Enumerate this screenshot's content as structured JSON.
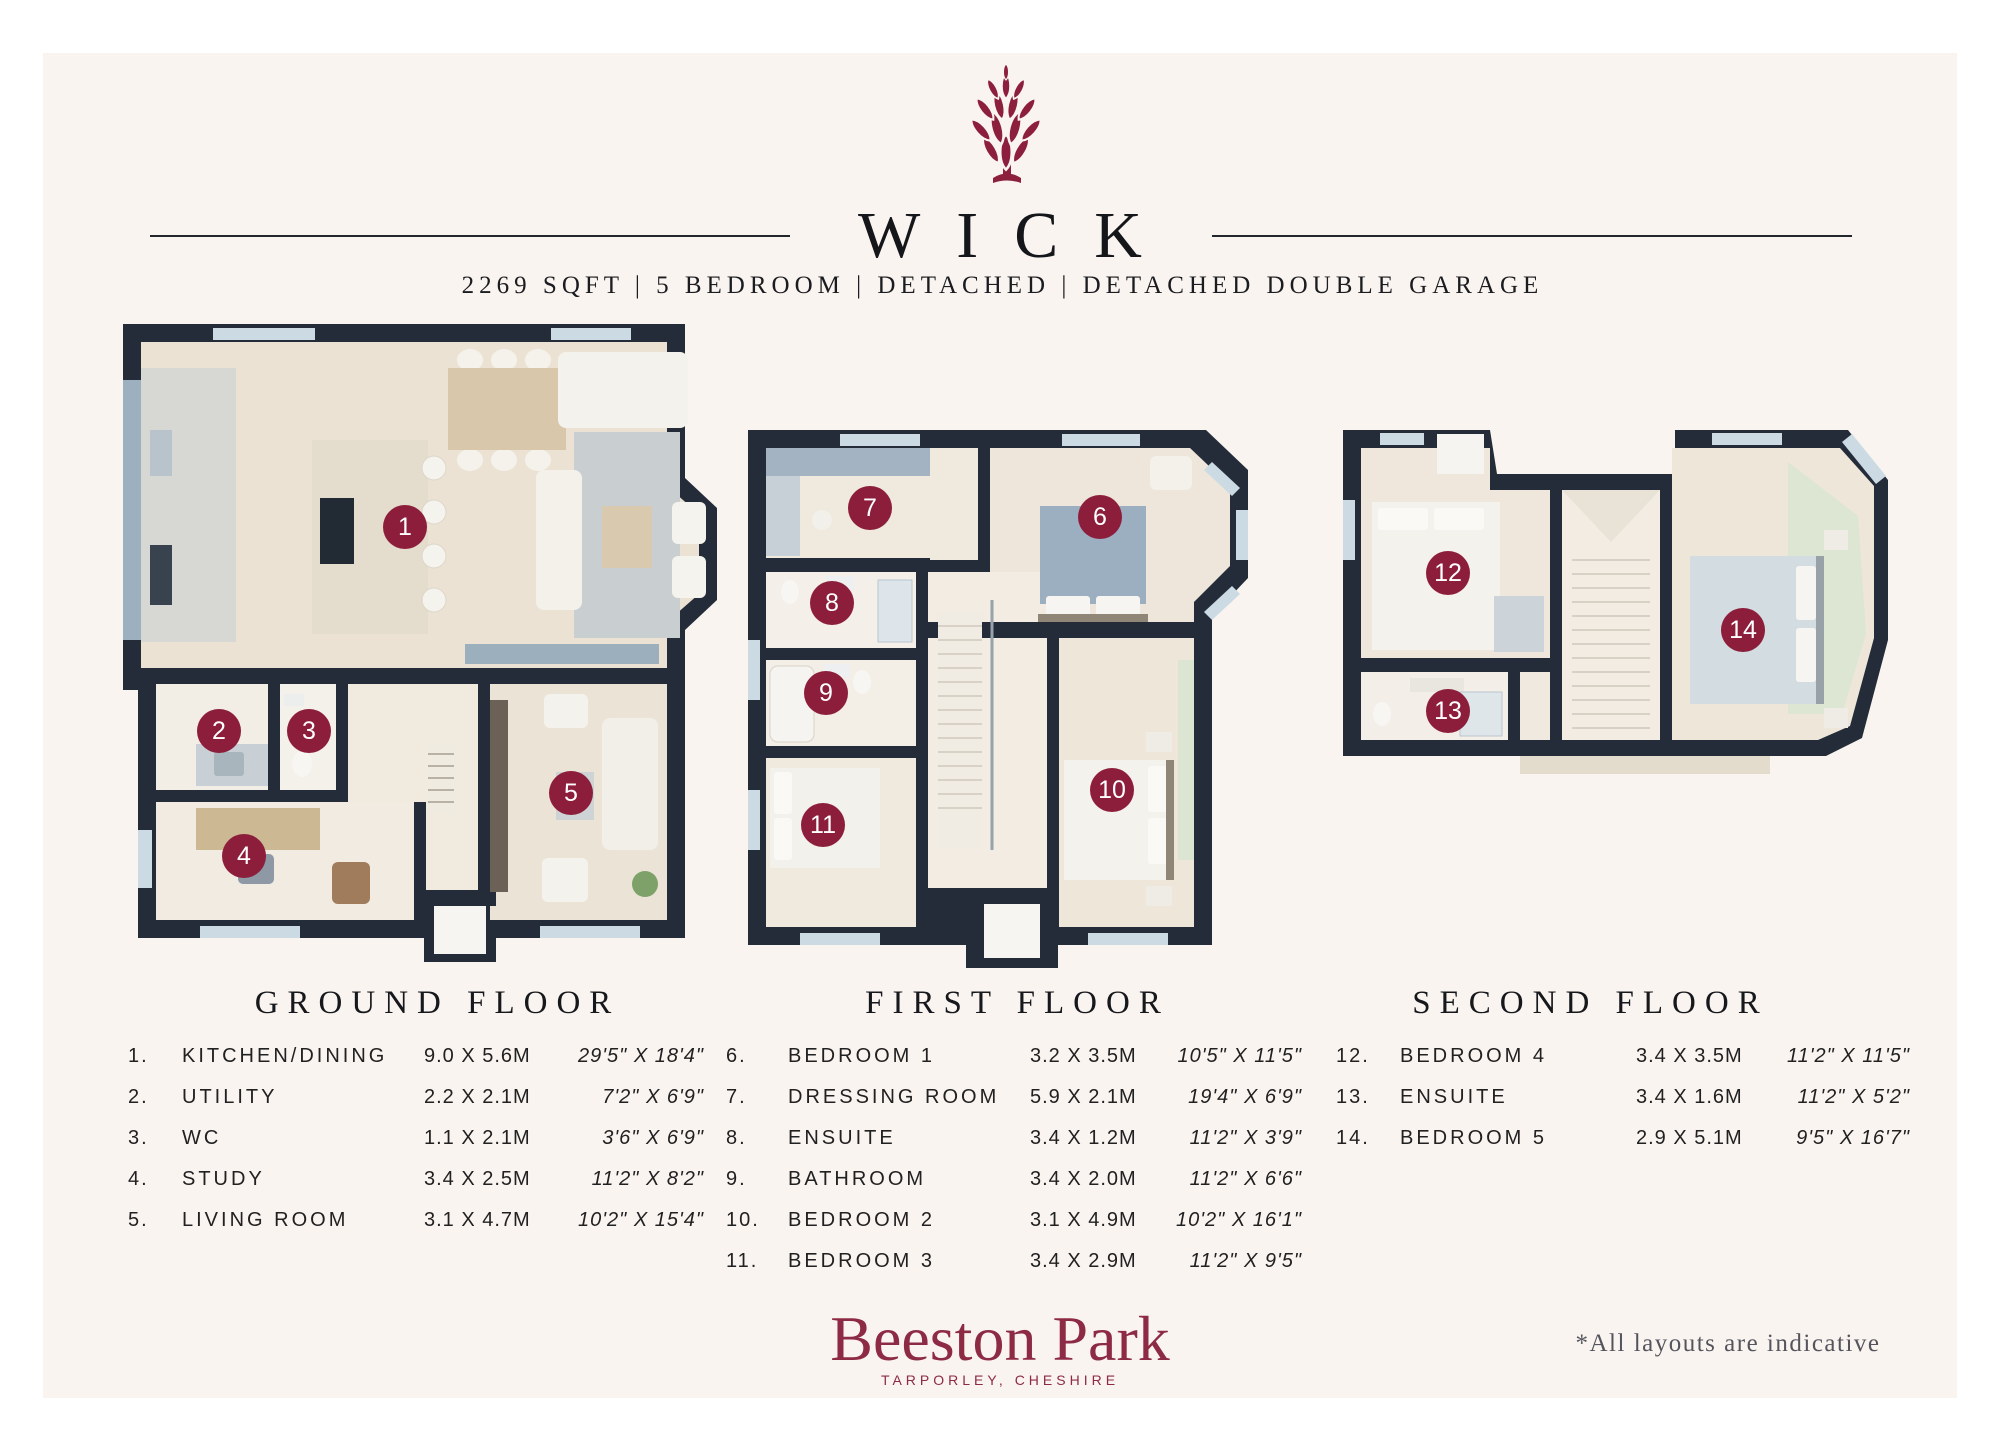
{
  "header": {
    "logo": "artichoke-logo",
    "title": "WICK",
    "subtitle": "2269 SQFT | 5 BEDROOM | DETACHED | DETACHED DOUBLE GARAGE"
  },
  "floors": [
    {
      "label": "GROUND FLOOR",
      "rooms": [
        {
          "num": "1.",
          "marker": "1",
          "name": "KITCHEN/DINING",
          "metric": "9.0 X 5.6M",
          "imperial": "29'5\" X 18'4\""
        },
        {
          "num": "2.",
          "marker": "2",
          "name": "UTILITY",
          "metric": "2.2 X 2.1M",
          "imperial": "7'2\" X 6'9\""
        },
        {
          "num": "3.",
          "marker": "3",
          "name": "WC",
          "metric": "1.1 X 2.1M",
          "imperial": "3'6\" X 6'9\""
        },
        {
          "num": "4.",
          "marker": "4",
          "name": "STUDY",
          "metric": "3.4 X 2.5M",
          "imperial": "11'2\" X 8'2\""
        },
        {
          "num": "5.",
          "marker": "5",
          "name": "LIVING ROOM",
          "metric": "3.1 X 4.7M",
          "imperial": "10'2\" X 15'4\""
        }
      ]
    },
    {
      "label": "FIRST FLOOR",
      "rooms": [
        {
          "num": "6.",
          "marker": "6",
          "name": "BEDROOM 1",
          "metric": "3.2 X 3.5M",
          "imperial": "10'5\" X 11'5\""
        },
        {
          "num": "7.",
          "marker": "7",
          "name": "DRESSING ROOM",
          "metric": "5.9 X 2.1M",
          "imperial": "19'4\" X 6'9\""
        },
        {
          "num": "8.",
          "marker": "8",
          "name": "ENSUITE",
          "metric": "3.4 X 1.2M",
          "imperial": "11'2\" X 3'9\""
        },
        {
          "num": "9.",
          "marker": "9",
          "name": "BATHROOM",
          "metric": "3.4 X 2.0M",
          "imperial": "11'2\" X 6'6\""
        },
        {
          "num": "10.",
          "marker": "10",
          "name": "BEDROOM 2",
          "metric": "3.1 X 4.9M",
          "imperial": "10'2\" X 16'1\""
        },
        {
          "num": "11.",
          "marker": "11",
          "name": "BEDROOM 3",
          "metric": "3.4 X 2.9M",
          "imperial": "11'2\" X 9'5\""
        }
      ]
    },
    {
      "label": "SECOND FLOOR",
      "rooms": [
        {
          "num": "12.",
          "marker": "12",
          "name": "BEDROOM 4",
          "metric": "3.4 X 3.5M",
          "imperial": "11'2\" X 11'5\""
        },
        {
          "num": "13.",
          "marker": "13",
          "name": "ENSUITE",
          "metric": "3.4 X 1.6M",
          "imperial": "11'2\" X 5'2\""
        },
        {
          "num": "14.",
          "marker": "14",
          "name": "BEDROOM 5",
          "metric": "2.9 X 5.1M",
          "imperial": "9'5\" X 16'7\""
        }
      ]
    }
  ],
  "footer": {
    "brand": "Beeston Park",
    "brand_location": "TARPORLEY, CHESHIRE",
    "disclaimer": "*All layouts are indicative"
  },
  "colors": {
    "accent_maroon": "#8c1e3b",
    "brand_maroon": "#8d2a44",
    "wall_navy": "#232c38",
    "panel_cream": "#faf4f1",
    "floor_beige": "#ece2d4",
    "window_blue": "#ccdae4"
  }
}
